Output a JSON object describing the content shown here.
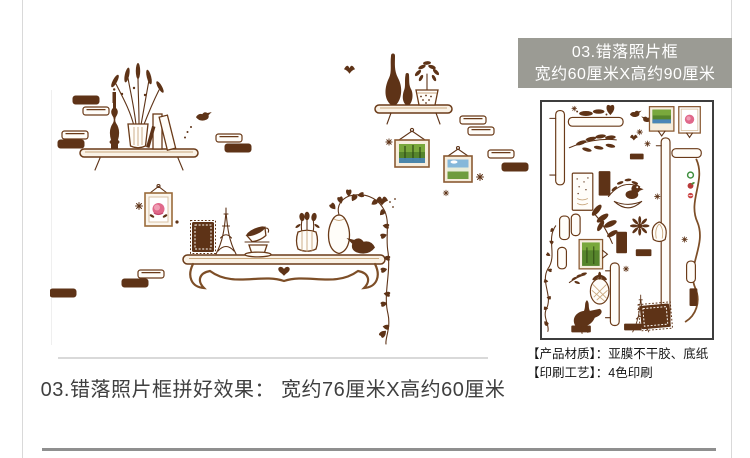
{
  "caption": "03.错落照片框拼好效果： 宽约76厘米X高约60厘米",
  "right_panel": {
    "header": {
      "line1": "03.错落照片框",
      "line2": "宽约60厘米X高约90厘米"
    },
    "specs": [
      "【产品材质】：亚膜不干胶、底纸",
      "【印刷工艺】：4色印刷"
    ]
  },
  "artwork": {
    "preview_motifs": [
      "wall-shelves",
      "candlestick",
      "dried-lavender-vase",
      "books",
      "tall-vases",
      "potted-plant",
      "photo-frame-forest",
      "photo-frame-meadow",
      "photo-frame-rose",
      "postage-stamp-frame",
      "eiffel-tower",
      "teacups",
      "flower-vase",
      "pothos-vase",
      "hanging-vine",
      "birds",
      "butterflies",
      "bricks",
      "sparkle-stars"
    ],
    "sheet_motifs": [
      "shelf-planks",
      "scroll-brackets",
      "photo-frames",
      "leaf-branches",
      "birds",
      "goose",
      "pineapple",
      "eiffel-tower",
      "stamp-frame",
      "vine",
      "bricks",
      "fruit-decals"
    ]
  },
  "colors": {
    "artwork_brown": "#5e3317",
    "artwork_outline": "#8a5a33",
    "header_bg": "#9b9b94",
    "header_text": "#ffffff",
    "photo_green": "#56852c",
    "photo_sky": "#85b8da",
    "photo_water": "#4a86b8",
    "flower_pink": "#e0688a",
    "caption_text": "#3f3f3f"
  }
}
